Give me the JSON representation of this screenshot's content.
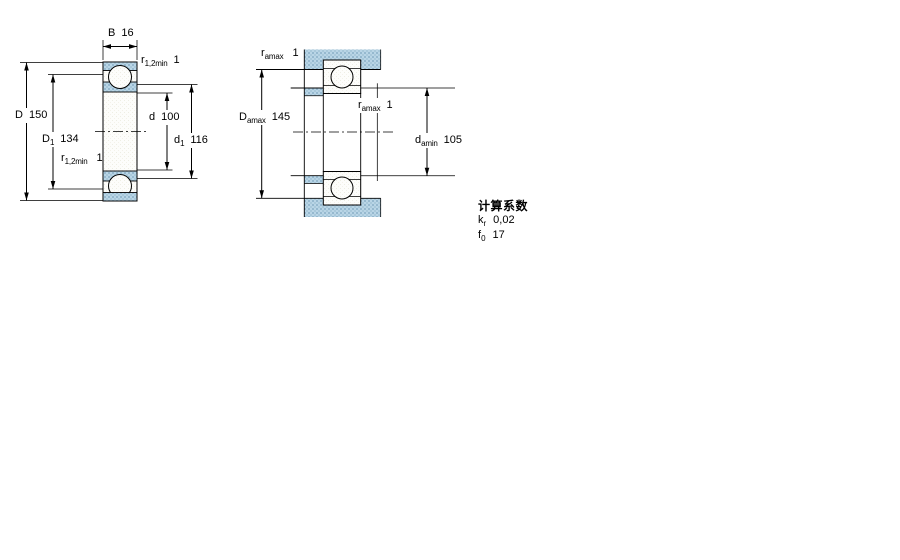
{
  "colors": {
    "background": "#ffffff",
    "line": "#000000",
    "steel_section_fill": "#b9d5e6",
    "steel_section_dot": "#96b9cf",
    "paper_fill": "#fdfdfb"
  },
  "left_view": {
    "B": {
      "symbol": "B",
      "value": "16"
    },
    "r_top": {
      "symbol": "r",
      "sub": "1,2min",
      "value": "1"
    },
    "D": {
      "symbol": "D",
      "value": "150"
    },
    "D1": {
      "symbol": "D",
      "sub": "1",
      "value": "134"
    },
    "d": {
      "symbol": "d",
      "value": "100"
    },
    "d1": {
      "symbol": "d",
      "sub": "1",
      "value": "116"
    },
    "r_bottom": {
      "symbol": "r",
      "sub": "1,2min",
      "value": "1"
    }
  },
  "right_view": {
    "r_top": {
      "symbol": "r",
      "sub": "amax",
      "value": "1"
    },
    "Da": {
      "symbol": "D",
      "sub": "amax",
      "value": "145"
    },
    "r_mid": {
      "symbol": "r",
      "sub": "amax",
      "value": "1"
    },
    "da": {
      "symbol": "d",
      "sub": "amin",
      "value": "105"
    }
  },
  "calculation_factors": {
    "heading": "计算系数",
    "rows": [
      {
        "symbol": "k",
        "sub": "r",
        "value": "0,02"
      },
      {
        "symbol": "f",
        "sub": "0",
        "value": "17"
      }
    ]
  }
}
